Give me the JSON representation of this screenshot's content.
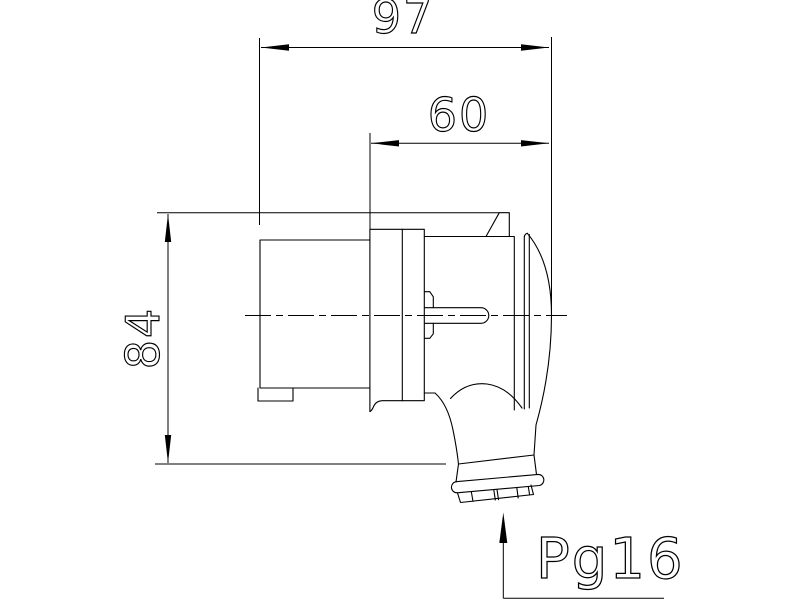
{
  "labels": {
    "overall_length": "97",
    "front_length": "60",
    "overall_height": "84",
    "cable_gland": "Pg16"
  },
  "colors": {
    "line": "#000000",
    "background": "#ffffff"
  }
}
